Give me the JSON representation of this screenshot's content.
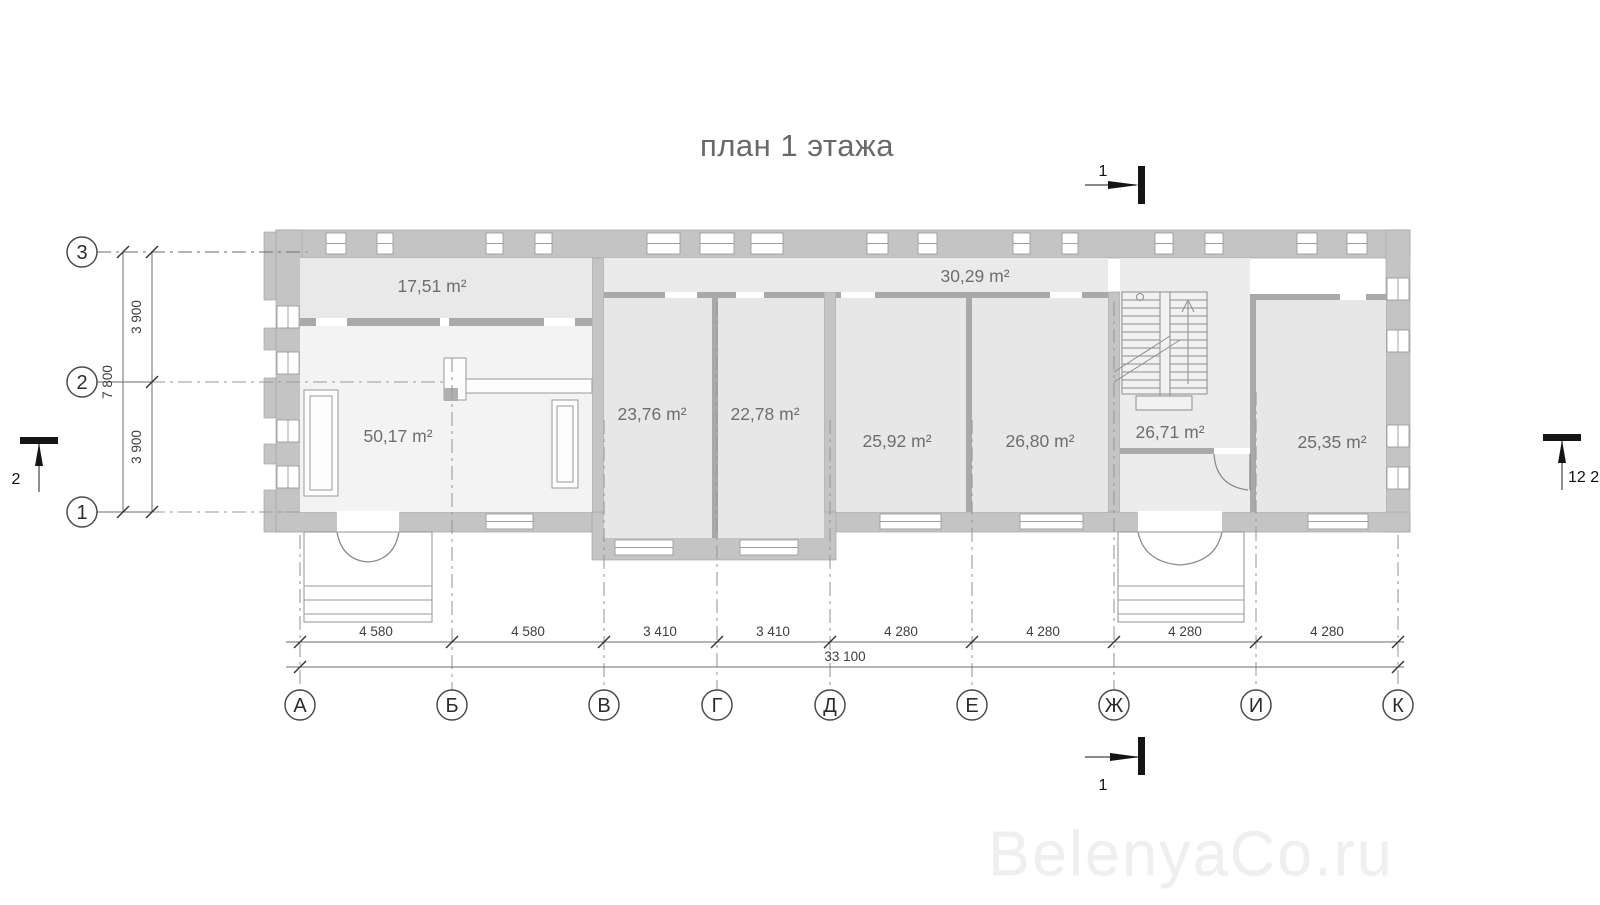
{
  "title": "план 1 этажа",
  "watermark": "BelenyaCo.ru",
  "plan": {
    "rooms": [
      {
        "name": "room-17-51",
        "label": "17,51 m²",
        "x": 432,
        "y": 292
      },
      {
        "name": "room-50-17",
        "label": "50,17 m²",
        "x": 398,
        "y": 442
      },
      {
        "name": "room-23-76",
        "label": "23,76 m²",
        "x": 652,
        "y": 420
      },
      {
        "name": "room-22-78",
        "label": "22,78 m²",
        "x": 765,
        "y": 420
      },
      {
        "name": "corridor-30-29",
        "label": "30,29 m²",
        "x": 975,
        "y": 282
      },
      {
        "name": "room-25-92",
        "label": "25,92 m²",
        "x": 897,
        "y": 447
      },
      {
        "name": "room-26-80",
        "label": "26,80 m²",
        "x": 1040,
        "y": 447
      },
      {
        "name": "stair-hall-26-71",
        "label": "26,71 m²",
        "x": 1170,
        "y": 438
      },
      {
        "name": "room-25-35",
        "label": "25,35 m²",
        "x": 1332,
        "y": 448
      }
    ]
  },
  "axes": {
    "columns": [
      {
        "label": "А",
        "x": 300
      },
      {
        "label": "Б",
        "x": 452
      },
      {
        "label": "В",
        "x": 604
      },
      {
        "label": "Г",
        "x": 717
      },
      {
        "label": "Д",
        "x": 830
      },
      {
        "label": "Е",
        "x": 972
      },
      {
        "label": "Ж",
        "x": 1114
      },
      {
        "label": "И",
        "x": 1256
      },
      {
        "label": "К",
        "x": 1398
      }
    ],
    "rows": [
      {
        "label": "3",
        "y": 252
      },
      {
        "label": "2",
        "y": 382
      },
      {
        "label": "1",
        "y": 512
      }
    ]
  },
  "dimensions": {
    "bottom": [
      {
        "label": "4 580",
        "x": 376
      },
      {
        "label": "4 580",
        "x": 528
      },
      {
        "label": "3 410",
        "x": 660
      },
      {
        "label": "3 410",
        "x": 773
      },
      {
        "label": "4 280",
        "x": 901
      },
      {
        "label": "4 280",
        "x": 1043
      },
      {
        "label": "4 280",
        "x": 1185
      },
      {
        "label": "4 280",
        "x": 1327
      }
    ],
    "bottom_total": {
      "label": "33 100",
      "x": 845
    },
    "left": [
      {
        "label": "3 900",
        "y": 317
      },
      {
        "label": "3 900",
        "y": 447
      }
    ],
    "left_total": {
      "label": "7 800",
      "y": 382
    }
  },
  "section_markers": [
    {
      "pos": "top",
      "label": "1"
    },
    {
      "pos": "bottom",
      "label": "1"
    },
    {
      "pos": "left",
      "label": "2"
    },
    {
      "pos": "right",
      "label": "12 2"
    }
  ],
  "colors": {
    "wall": "#c4c4c4",
    "room_fill": "#e9e9e9",
    "room_light": "#f3f3f3",
    "watermark": "#efefef"
  }
}
